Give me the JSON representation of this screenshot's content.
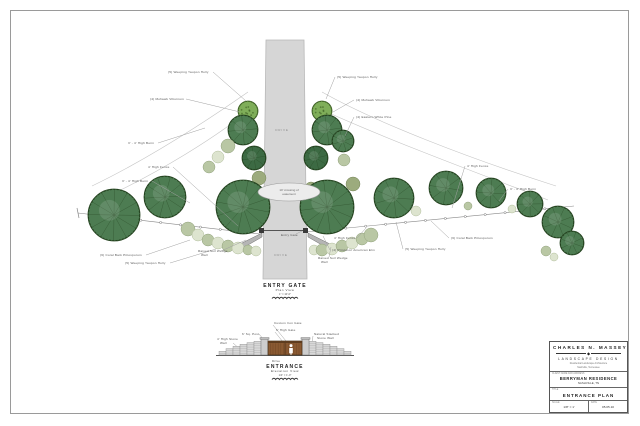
{
  "titleblock": {
    "firm_name": "Charles N. Massey",
    "diamond_icon": "◆",
    "firm_field": "Landscape Design",
    "firm_sub1": "Residential Landscape Architecture",
    "firm_sub2": "Nashville, Tennessee",
    "client_label": "Client Name and Address",
    "client_name": "Berryman Residence",
    "client_city": "Nashville, TN",
    "title_label": "Title",
    "sheet_title": "Entrance Plan",
    "scale_label": "Scale",
    "scale_value": "1/8\" = 1'",
    "date_label": "Date",
    "date_value": "05.05.10"
  },
  "palette": {
    "pine": "#4d7c52",
    "pine_edge": "#24421f",
    "holly": "#3c6a43",
    "vib": "#7fae59",
    "vib_edge": "#3a5c22",
    "sage": "#b9c7a4",
    "sage_edge": "#93a37e",
    "pale": "#dde4cf",
    "pale_edge": "#b3bf9e",
    "olive": "#9cab7d",
    "olive_edge": "#77865b",
    "drive": "#d6d6d6",
    "drive_edge": "#b8b8b8",
    "stone": "#d8d8d8",
    "gate_wood": "#8a5a32",
    "label": "#555555",
    "leader": "#a0a0a0",
    "line": "#888888"
  },
  "plan": {
    "view_title": "ENTRY GATE",
    "view_subtitle": "Plan View",
    "view_scale": "1\" = 10'-0\"",
    "drive_label": "DRIVE",
    "easement_line1": "10' crossing of",
    "easement_line2": "easement",
    "drive_pts": "266,40 304,40 307,279 263,279",
    "drive_label_pos": [
      [
        282,
        131
      ],
      [
        281,
        256
      ]
    ],
    "easement": {
      "cx": 289,
      "cy": 192,
      "rx": 31,
      "ry": 9
    },
    "fences": [
      {
        "a": [
          260,
          234
        ],
        "b": [
          78,
          213
        ]
      },
      {
        "a": [
          306,
          232
        ],
        "b": [
          574,
          206
        ]
      }
    ],
    "berms": [
      "M92 186 C150 158 205 122 248 92",
      "M100 200 C160 172 215 138 252 108",
      "M322 92 C375 122 468 158 556 186",
      "M318 108 C388 140 480 174 548 200"
    ],
    "wedges": [
      [
        [
          238,
          245
        ],
        [
          262,
          233
        ],
        [
          262,
          237
        ],
        [
          241,
          249
        ]
      ],
      [
        [
          308,
          233
        ],
        [
          332,
          245
        ],
        [
          329,
          249
        ],
        [
          308,
          237
        ]
      ]
    ],
    "gateposts": [
      [
        259,
        228
      ],
      [
        303,
        228
      ]
    ],
    "trees": [
      [
        248,
        111,
        10,
        "vib"
      ],
      [
        243,
        130,
        15,
        "pine"
      ],
      [
        254,
        158,
        12,
        "holly"
      ],
      [
        228,
        146,
        7,
        "sage"
      ],
      [
        218,
        157,
        6,
        "pale"
      ],
      [
        209,
        167,
        6,
        "sage"
      ],
      [
        259,
        178,
        7,
        "olive"
      ],
      [
        251,
        189,
        6,
        "olive"
      ],
      [
        165,
        197,
        21,
        "pine"
      ],
      [
        114,
        215,
        26,
        "pine"
      ],
      [
        243,
        207,
        27,
        "pine"
      ],
      [
        188,
        229,
        7,
        "sage"
      ],
      [
        198,
        235,
        6,
        "pale"
      ],
      [
        208,
        240,
        6,
        "sage"
      ],
      [
        218,
        243,
        6,
        "pale"
      ],
      [
        228,
        246,
        6,
        "sage"
      ],
      [
        238,
        248,
        6,
        "pale"
      ],
      [
        248,
        250,
        5,
        "sage"
      ],
      [
        256,
        251,
        5,
        "pale"
      ],
      [
        322,
        111,
        10,
        "vib"
      ],
      [
        327,
        130,
        15,
        "pine"
      ],
      [
        316,
        158,
        12,
        "holly"
      ],
      [
        343,
        141,
        11,
        "pine"
      ],
      [
        344,
        160,
        6,
        "sage"
      ],
      [
        311,
        188,
        6,
        "olive"
      ],
      [
        353,
        184,
        7,
        "olive"
      ],
      [
        327,
        207,
        27,
        "pine"
      ],
      [
        314,
        250,
        5,
        "pale"
      ],
      [
        322,
        250,
        6,
        "sage"
      ],
      [
        332,
        249,
        6,
        "pale"
      ],
      [
        342,
        246,
        6,
        "sage"
      ],
      [
        352,
        243,
        6,
        "pale"
      ],
      [
        362,
        239,
        6,
        "sage"
      ],
      [
        371,
        235,
        7,
        "sage"
      ],
      [
        394,
        198,
        20,
        "pine"
      ],
      [
        446,
        188,
        17,
        "pine"
      ],
      [
        491,
        193,
        15,
        "pine"
      ],
      [
        530,
        204,
        13,
        "pine"
      ],
      [
        416,
        211,
        5,
        "pale"
      ],
      [
        468,
        206,
        4,
        "sage"
      ],
      [
        512,
        209,
        4,
        "pale"
      ],
      [
        558,
        222,
        16,
        "pine"
      ],
      [
        572,
        243,
        12,
        "pine"
      ],
      [
        546,
        251,
        5,
        "sage"
      ],
      [
        554,
        257,
        4,
        "pale"
      ]
    ],
    "labels": [
      {
        "lines": [
          "(5) Weeping Yaupon Holly"
        ],
        "x": 168,
        "y": 73,
        "leader": [
          [
            213,
            72
          ],
          [
            246,
            101
          ]
        ]
      },
      {
        "lines": [
          "(4) Mohawk Viburnum"
        ],
        "x": 150,
        "y": 100,
        "leader": [
          [
            186,
            99
          ],
          [
            240,
            112
          ]
        ]
      },
      {
        "lines": [
          "3' - 4' High Berm"
        ],
        "x": 128,
        "y": 144,
        "leader": [
          [
            158,
            143
          ],
          [
            205,
            128
          ]
        ]
      },
      {
        "lines": [
          "4' High Fence"
        ],
        "x": 148,
        "y": 168,
        "leader": [
          [
            173,
            167
          ],
          [
            238,
            226
          ]
        ]
      },
      {
        "lines": [
          "3' - 4' High Berm"
        ],
        "x": 122,
        "y": 182,
        "leader": [
          [
            152,
            181
          ],
          [
            190,
            203
          ]
        ]
      },
      {
        "lines": [
          "(6) Coral Bark Pittosporum"
        ],
        "x": 100,
        "y": 256,
        "leader": [
          [
            146,
            255
          ],
          [
            190,
            240
          ]
        ]
      },
      {
        "lines": [
          "(5) Weeping Yaupon Holly"
        ],
        "x": 125,
        "y": 264,
        "leader": [
          [
            170,
            263
          ],
          [
            216,
            249
          ]
        ]
      },
      {
        "lines": [
          "Entry Gate"
        ],
        "x": 281,
        "y": 236,
        "leader": [
          [
            296,
            234
          ],
          [
            302,
            231
          ]
        ]
      },
      {
        "lines": [
          "Raised Soil Wedge",
          "Wall"
        ],
        "x": 198,
        "y": 252,
        "leader": [
          [
            221,
            251
          ],
          [
            246,
            240
          ]
        ]
      },
      {
        "lines": [
          "Raised Soil Wedge",
          "Wall"
        ],
        "x": 318,
        "y": 259,
        "leader": [
          [
            329,
            257
          ],
          [
            331,
            247
          ]
        ]
      },
      {
        "lines": [
          "4' High Fence"
        ],
        "x": 334,
        "y": 239,
        "leader": [
          [
            357,
            238
          ],
          [
            366,
            228
          ]
        ]
      },
      {
        "lines": [
          "(4) Princeton American Elm"
        ],
        "x": 332,
        "y": 251,
        "leader": [
          [
            330,
            250
          ],
          [
            323,
            236
          ]
        ]
      },
      {
        "lines": [
          "(5) Weeping Yaupon Holly"
        ],
        "x": 337,
        "y": 78,
        "leader": [
          [
            335,
            77
          ],
          [
            326,
            99
          ]
        ]
      },
      {
        "lines": [
          "(4) Mohawk Viburnum"
        ],
        "x": 356,
        "y": 101,
        "leader": [
          [
            354,
            100
          ],
          [
            333,
            112
          ]
        ]
      },
      {
        "lines": [
          "(4) Eastern White Pine"
        ],
        "x": 356,
        "y": 118,
        "leader": [
          [
            354,
            117
          ],
          [
            345,
            136
          ]
        ]
      },
      {
        "lines": [
          "4' High Fence"
        ],
        "x": 467,
        "y": 167,
        "leader": [
          [
            465,
            166
          ],
          [
            452,
            208
          ]
        ]
      },
      {
        "lines": [
          "3' - 4' High Berm"
        ],
        "x": 510,
        "y": 190,
        "leader": [
          [
            508,
            189
          ],
          [
            499,
            201
          ]
        ]
      },
      {
        "lines": [
          "(6) Coral Bark Pittosporum"
        ],
        "x": 451,
        "y": 239,
        "leader": [
          [
            449,
            238
          ],
          [
            431,
            221
          ]
        ]
      },
      {
        "lines": [
          "(5) Weeping Yaupon Holly"
        ],
        "x": 405,
        "y": 250,
        "leader": [
          [
            403,
            249
          ],
          [
            396,
            222
          ]
        ]
      }
    ]
  },
  "elevation": {
    "view_title": "ENTRANCE",
    "view_subtitle": "Elevation View",
    "view_scale": "1/4\" = 1'-0\"",
    "labels": [
      {
        "lines": [
          "Custom Iron Gate"
        ],
        "x": 274,
        "y": 324,
        "leader": [
          [
            273,
            325
          ],
          [
            286,
            341
          ]
        ]
      },
      {
        "lines": [
          "6' High Gate"
        ],
        "x": 276,
        "y": 331,
        "leader": [
          [
            275,
            332
          ],
          [
            283,
            342
          ]
        ]
      },
      {
        "lines": [
          "6' Sq. Post"
        ],
        "x": 242,
        "y": 335,
        "leader": [
          [
            259,
            334
          ],
          [
            264,
            340
          ]
        ]
      },
      {
        "lines": [
          "4' High Stone",
          "Wall"
        ],
        "x": 217,
        "y": 340,
        "leader": [
          [
            233,
            343
          ],
          [
            241,
            350
          ]
        ]
      },
      {
        "lines": [
          "Natural Stacked",
          "Stone Wall"
        ],
        "x": 314,
        "y": 335,
        "leader": [
          [
            313,
            336
          ],
          [
            312,
            343
          ]
        ]
      },
      {
        "lines": [
          "Drive"
        ],
        "x": 272,
        "y": 362
      }
    ]
  }
}
